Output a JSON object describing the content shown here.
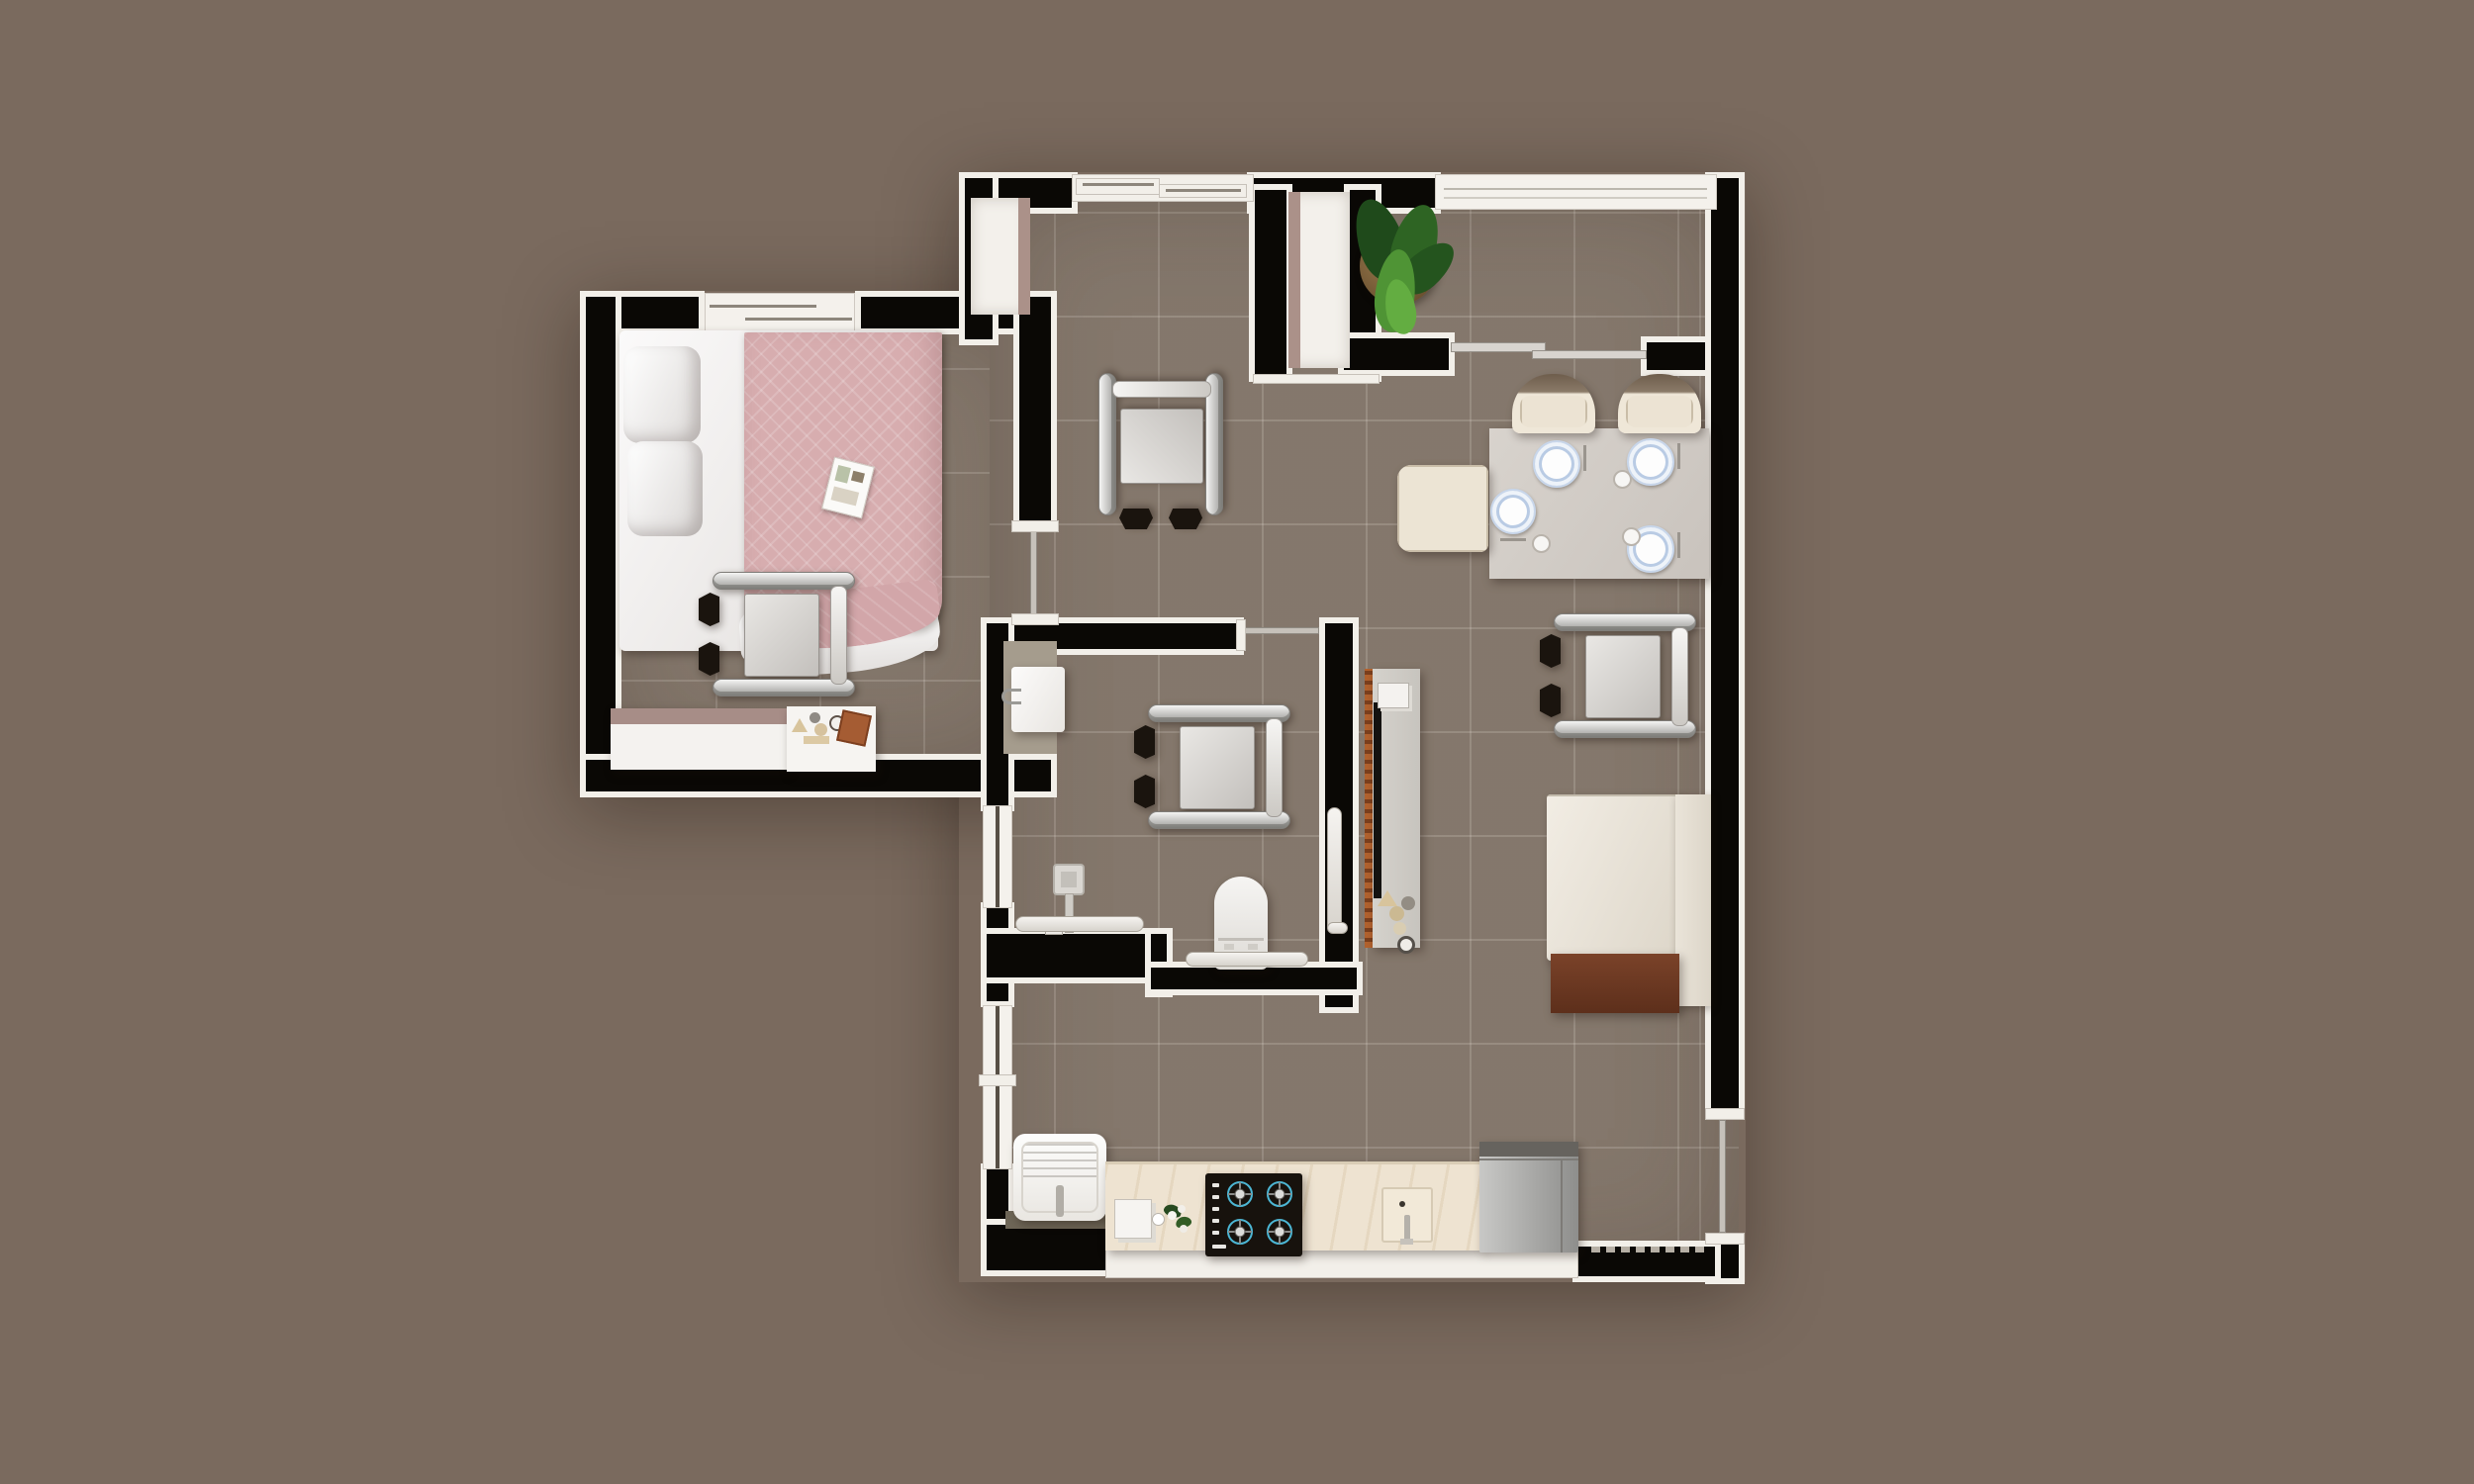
{
  "scene": {
    "title": "3D rendered floor plan — wheelchair-accessible one-bedroom apartment (top-down view)"
  },
  "palette": {
    "background": "#7a6a5e",
    "floor_tile": "#8b7e72",
    "wall_core": "#0a0805",
    "wall_liner": "#f2efe9",
    "accent_mauve": "#ab9189",
    "blanket_pink": "#d7adaf",
    "upholstery_cream": "#ece4d6",
    "wood_brown": "#7a4229",
    "plant_green": "#3f7a2e",
    "burner_ring_blue": "#4cb6d4",
    "counter_marble": "#eee3d1",
    "plate_rim_blue": "#b9cbe4",
    "stainless_gray": "#b0b0ae"
  },
  "rooms": {
    "bedroom": {
      "label": "Bedroom",
      "furniture": [
        "double bed with pink knit blanket",
        "two pillows",
        "open magazine",
        "wheelchair",
        "dresser with mauve top",
        "bedside table with decor"
      ]
    },
    "hallway": {
      "label": "Entry hallway",
      "furniture": [
        "wheelchair",
        "closet niche left",
        "closet niche right"
      ]
    },
    "vestibule": {
      "label": "Entry vestibule",
      "furniture": [
        "potted plant"
      ]
    },
    "dining_living": {
      "label": "Living and dining room",
      "furniture": [
        "dining table with four place settings",
        "two dining chairs",
        "tufted armchair",
        "wheelchair",
        "daybed with brown footboard",
        "wall TV on wood slat panel",
        "media console with decor objects"
      ]
    },
    "bathroom": {
      "label": "Accessible bathroom",
      "furniture": [
        "vanity with washbasin",
        "wheelchair",
        "toilet with grab bar",
        "roll-in shower with grab bars",
        "vertical wall grab bar"
      ]
    },
    "kitchen": {
      "label": "Kitchen and laundry",
      "furniture": [
        "laundry tub with faucet",
        "stone countertop",
        "small appliance",
        "flower vase",
        "four-burner gas cooktop",
        "built-in sink",
        "refrigerator"
      ]
    }
  },
  "openings": {
    "entry_sliding_door": "top wall, two offset panels",
    "bedroom_sliding_door": "bedroom right wall",
    "bathroom_sliding_door": "bathroom top wall",
    "dining_slider_rail": "between vestibule and dining room",
    "balcony_sliding_door": "right wall, lower section",
    "windows": [
      "bedroom top sliding window",
      "top-right window band",
      "left window at shower",
      "left window at kitchen"
    ]
  },
  "counts": {
    "wheelchairs": 4,
    "place_settings": 4,
    "stove_burners": 4,
    "dining_chairs": 2,
    "armchairs": 1,
    "closet_niches": 2,
    "grab_bars": 3
  }
}
